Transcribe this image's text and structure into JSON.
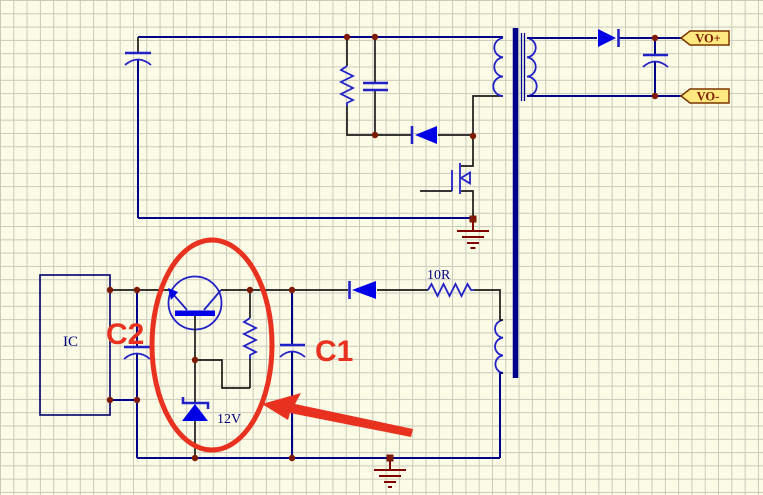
{
  "canvas": {
    "width": 763,
    "height": 495,
    "background": "#FCFBE6",
    "grid_color": "#C9C9BC",
    "grid_size_px": 13.3
  },
  "colors": {
    "wire": "#00008B",
    "pin": "#1a1a1a",
    "component": "#2121C8",
    "componentFill": "#0000E6",
    "junction": "#7D1A00",
    "ground": "#800000",
    "annotation": "#E8311F",
    "portFill": "#FFE87F",
    "portBorder": "#7D3500",
    "portText": "#7D2000",
    "labelText": "#000084",
    "bg": "#FCFBE6",
    "grid": "#C9C9BC"
  },
  "ports": {
    "positive": "VO+",
    "negative": "VO-"
  },
  "labels": {
    "ic": "IC",
    "resistor_value": "10R",
    "zener_voltage": "12V",
    "annotation_c2": "C2",
    "annotation_c1": "C1"
  },
  "components": [
    "input-capacitor",
    "snubber-resistor",
    "snubber-capacitor",
    "snubber-diode",
    "transformer-primary-winding",
    "transformer-secondary-winding",
    "transformer-aux-winding",
    "transformer-core",
    "mosfet",
    "output-diode",
    "output-capacitor",
    "ic-block",
    "transistor",
    "c2-capacitor",
    "c1-capacitor",
    "emitter-resistor",
    "series-diode",
    "resistor-10R",
    "zener-diode",
    "ground-symbol-primary",
    "ground-symbol-secondary",
    "port-vo-plus",
    "port-vo-minus",
    "red-ellipse-annotation",
    "red-arrow-annotation"
  ]
}
